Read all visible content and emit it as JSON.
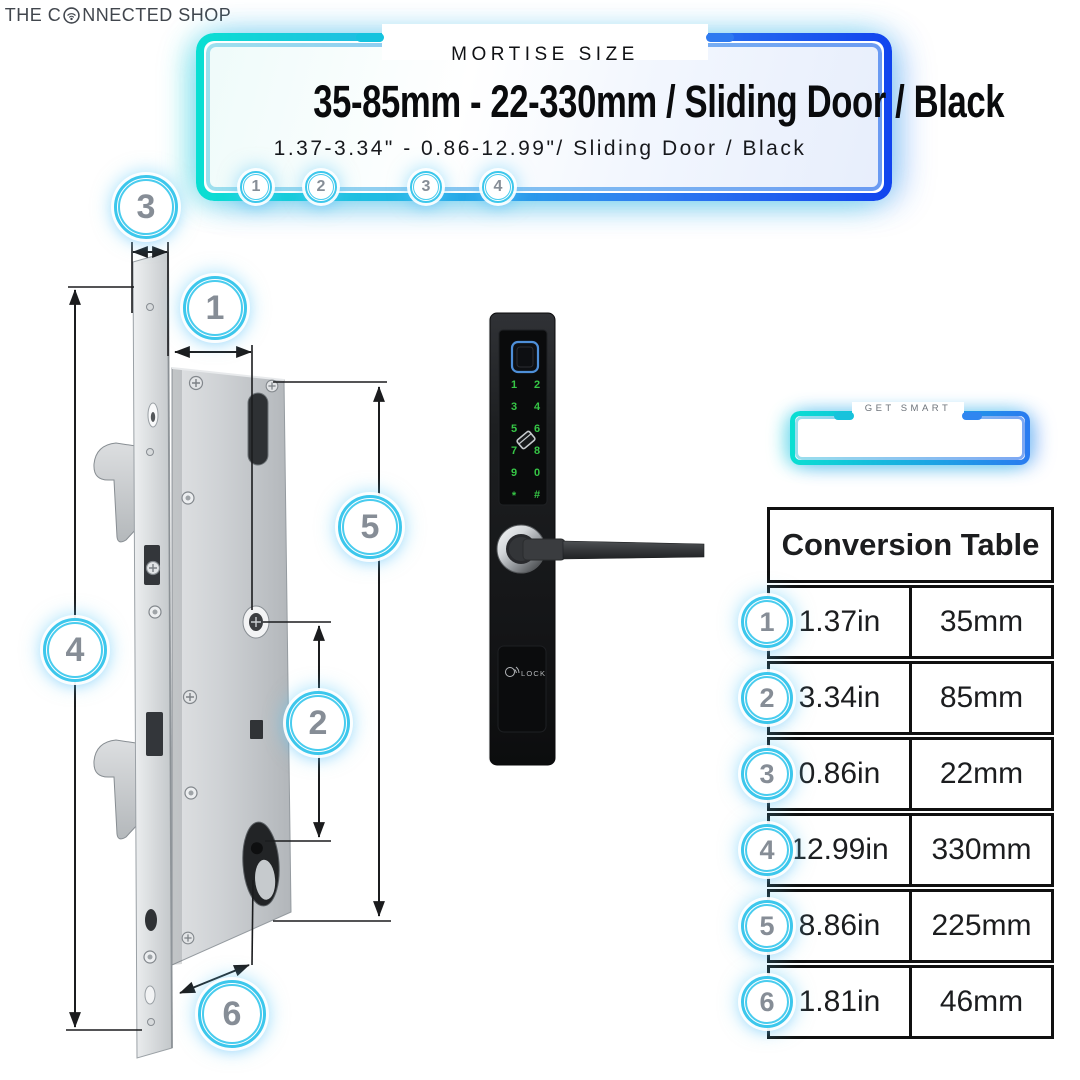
{
  "header": {
    "eyebrow": "MORTISE SIZE",
    "title": "35-85mm - 22-330mm / Sliding Door / Black",
    "subtitle": "1.37-3.34\" - 0.86-12.99\"/ Sliding Door / Black",
    "badges": [
      "1",
      "2",
      "3",
      "4"
    ]
  },
  "brand": {
    "tagline": "GET SMART",
    "name_pre": "THE C",
    "name_post": "NNECTED SHOP"
  },
  "diagram": {
    "badge_1": "1",
    "badge_2": "2",
    "badge_3": "3",
    "badge_4": "4",
    "badge_5": "5",
    "badge_6": "6"
  },
  "device": {
    "keypad": [
      "1",
      "2",
      "3",
      "4",
      "5",
      "6",
      "7",
      "8",
      "9",
      "0",
      "*",
      "#"
    ],
    "panel_label": "LOCK"
  },
  "conversion_table": {
    "title": "Conversion Table",
    "rows": [
      {
        "badge": "1",
        "inches": "1.37in",
        "millimeters": "35mm"
      },
      {
        "badge": "2",
        "inches": "3.34in",
        "millimeters": "85mm"
      },
      {
        "badge": "3",
        "inches": "0.86in",
        "millimeters": "22mm"
      },
      {
        "badge": "4",
        "inches": "12.99in",
        "millimeters": "330mm"
      },
      {
        "badge": "5",
        "inches": "8.86in",
        "millimeters": "225mm"
      },
      {
        "badge": "6",
        "inches": "1.81in",
        "millimeters": "46mm"
      }
    ]
  },
  "colors": {
    "accent_cyan": "#0adfd2",
    "accent_blue": "#1144ee",
    "badge_ring": "#3cc7ec",
    "badge_number": "#868d96",
    "keypad_green": "#36c646",
    "table_border": "#101010"
  }
}
